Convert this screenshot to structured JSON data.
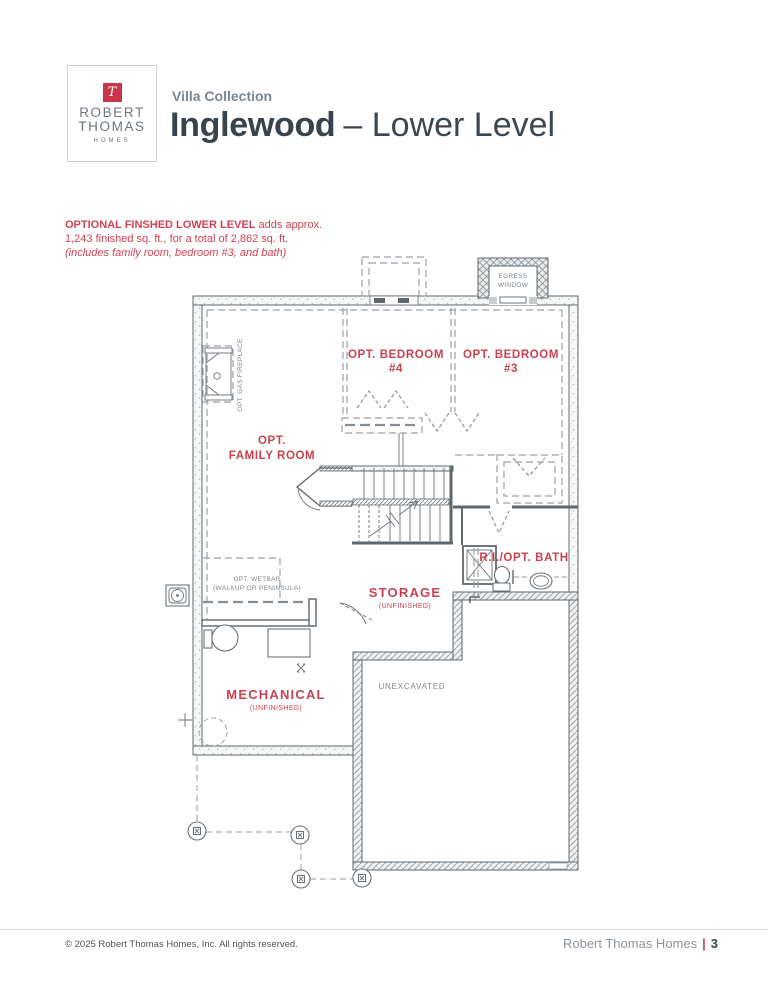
{
  "colors": {
    "accent_red": "#ce3f4e",
    "dark_text": "#39434e",
    "gray_text": "#7d868e",
    "wall_line": "#5f676d"
  },
  "logo": {
    "monogram": "T",
    "line1": "ROBERT",
    "line2": "THOMAS",
    "line3": "HOMES"
  },
  "header": {
    "collection": "Villa Collection",
    "plan": "Inglewood",
    "level": "– Lower Level"
  },
  "note": {
    "bold": "OPTIONAL FINSHED LOWER LEVEL",
    "rest": " adds approx.",
    "line2": "1,243 finished sq. ft., for a total of 2,862 sq. ft.",
    "line3": "(includes family room, bedroom #3, and bath)"
  },
  "plan": {
    "egress_1": "EGRESS",
    "egress_2": "WINDOW",
    "bedroom4_1": "OPT. BEDROOM",
    "bedroom4_2": "#4",
    "bedroom3_1": "OPT. BEDROOM",
    "bedroom3_2": "#3",
    "fireplace": "OPT. GAS FIREPLACE",
    "family_1": "OPT.",
    "family_2": "FAMILY ROOM",
    "wetbar_1": "OPT. WETBAR",
    "wetbar_2": "(WALKUP OR PENINSULA)",
    "storage_1": "STORAGE",
    "storage_2": "(UNFINISHED)",
    "bath": "R.I./OPT. BATH",
    "mech_1": "MECHANICAL",
    "mech_2": "(UNFINISHED)",
    "unexcavated": "UNEXCAVATED"
  },
  "footer": {
    "copyright": "© 2025 Robert Thomas Homes, Inc. All rights reserved.",
    "brand": "Robert Thomas Homes",
    "divider": "|",
    "page": "3"
  }
}
